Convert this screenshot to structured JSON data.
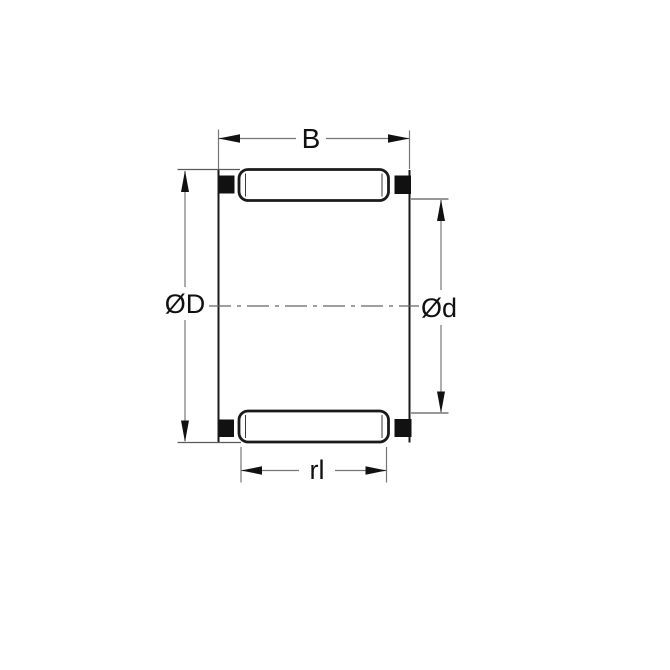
{
  "diagram": {
    "name": "needle-roller-bearing-cage-cross-section",
    "labels": {
      "width": "B",
      "outer_diameter": "ØD",
      "inner_diameter": "Ød",
      "roller_length": "rl"
    },
    "colors": {
      "background": "#ffffff",
      "outline": "#1a1a1a",
      "cage_block_fill": "#111111",
      "dimension_line": "#757575",
      "centerline": "#666666",
      "label_text": "#111111"
    }
  }
}
